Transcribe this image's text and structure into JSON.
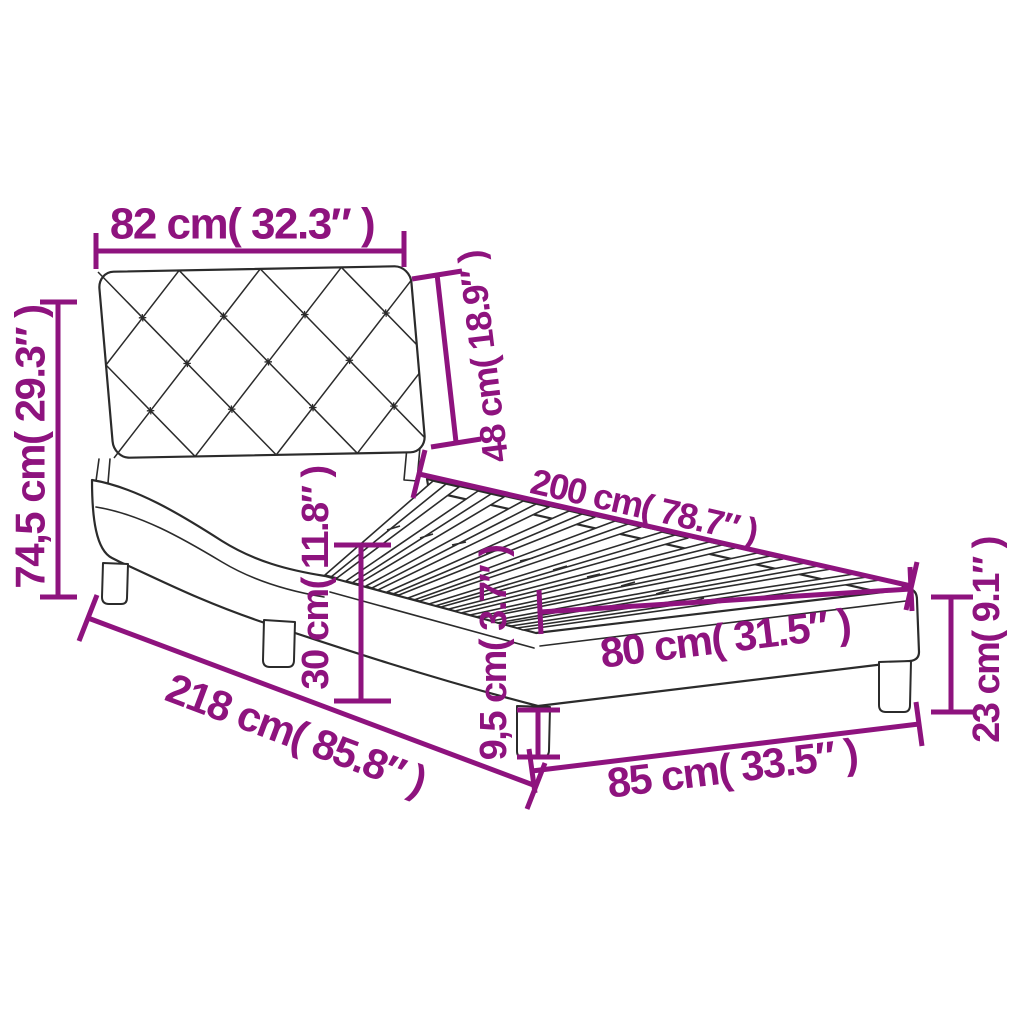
{
  "colors": {
    "dimension_accent": "#8E137E",
    "drawing_line": "#2B2B2B",
    "background": "#FFFFFF"
  },
  "dimensions": {
    "headboard_width": "82 cm( 32.3″ )",
    "headboard_height": "48 cm( 18.9″ )",
    "total_height": "74,5 cm( 29.3″ )",
    "bed_length": "200 cm( 78.7″ )",
    "platform_height": "30 cm( 11.8″ )",
    "slat_area_width": "80 cm( 31.5″ )",
    "total_length": "218 cm( 85.8″ )",
    "leg_height": "9,5 cm( 3.7″ )",
    "total_width": "85 cm( 33.5″ )",
    "frame_height": "23 cm( 9.1″ )"
  }
}
